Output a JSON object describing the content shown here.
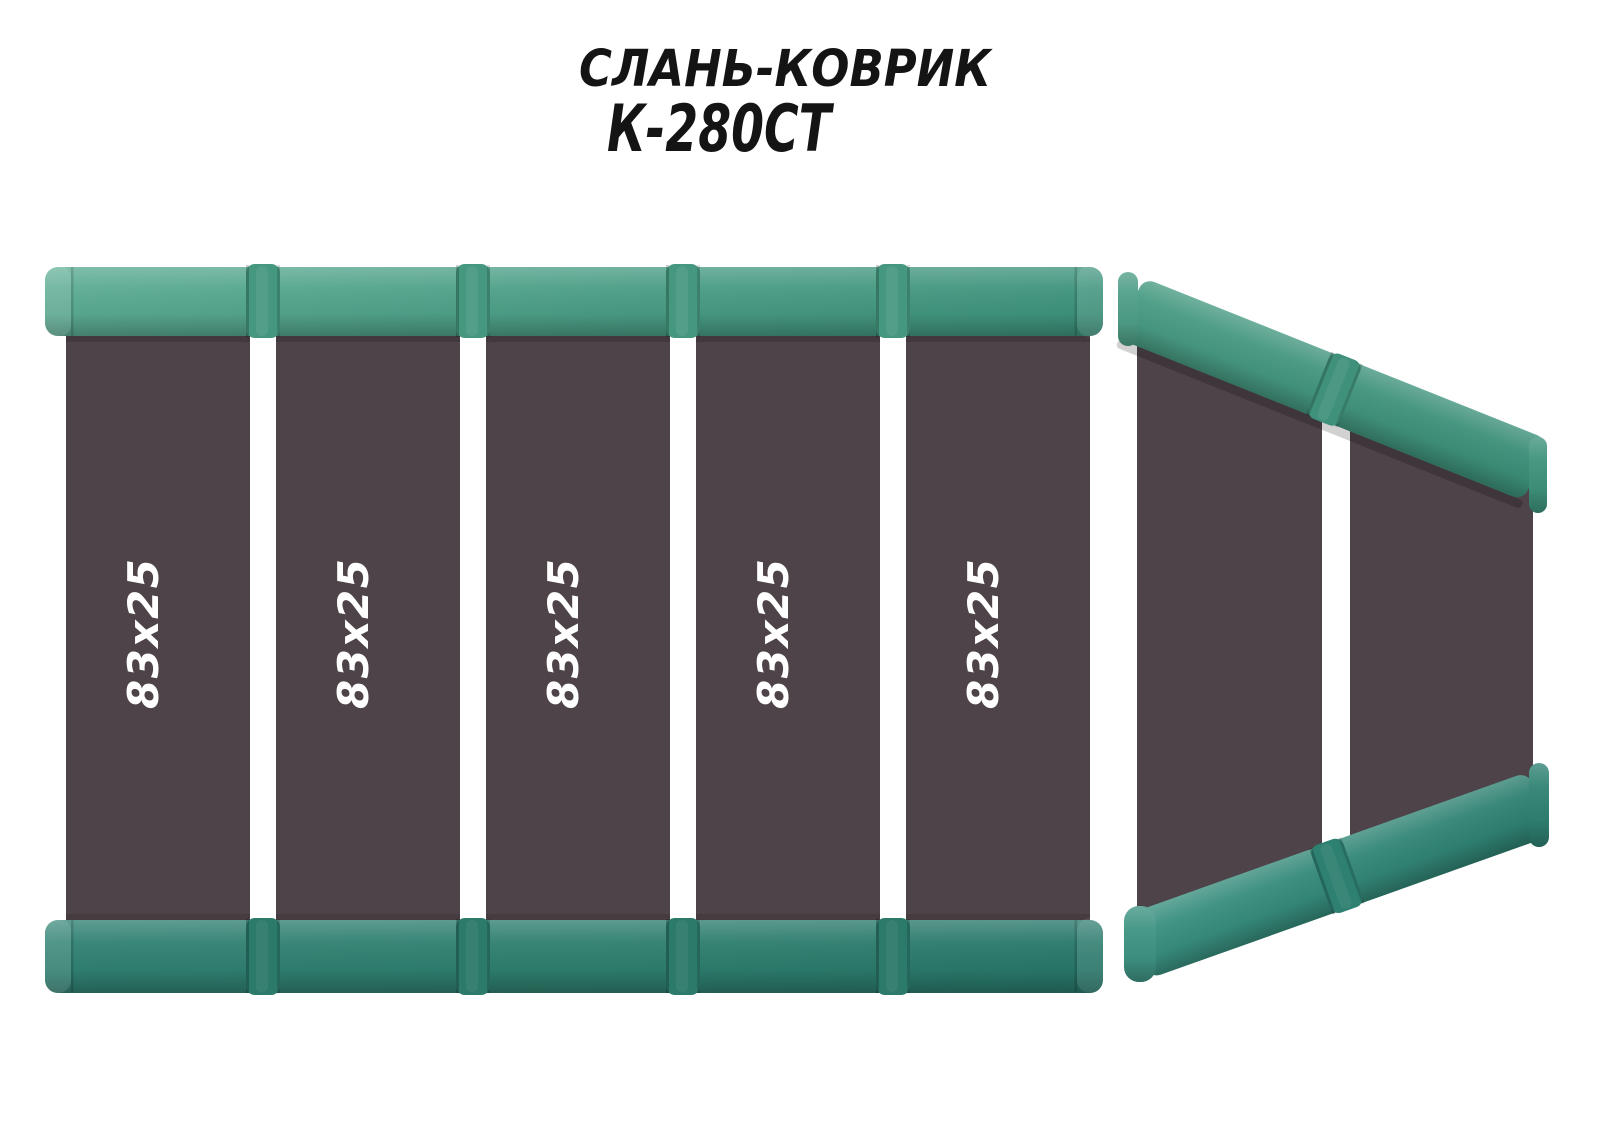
{
  "title": {
    "product_type": "СЛАНЬ-КОВРИК",
    "model": "К-280СТ"
  },
  "mat": {
    "panels": [
      {
        "label": "83х25"
      },
      {
        "label": "83х25"
      },
      {
        "label": "83х25"
      },
      {
        "label": "83х25"
      },
      {
        "label": "83х25"
      }
    ]
  },
  "colors": {
    "background": "#ffffff",
    "title_text": "#141414",
    "panel_fill": "#4d4348",
    "panel_label_text": "#ffffff",
    "top_strip_green": "#4b9e86",
    "bottom_strip_green": "#2e7f6e",
    "bow_strip_green": "#41947e"
  }
}
